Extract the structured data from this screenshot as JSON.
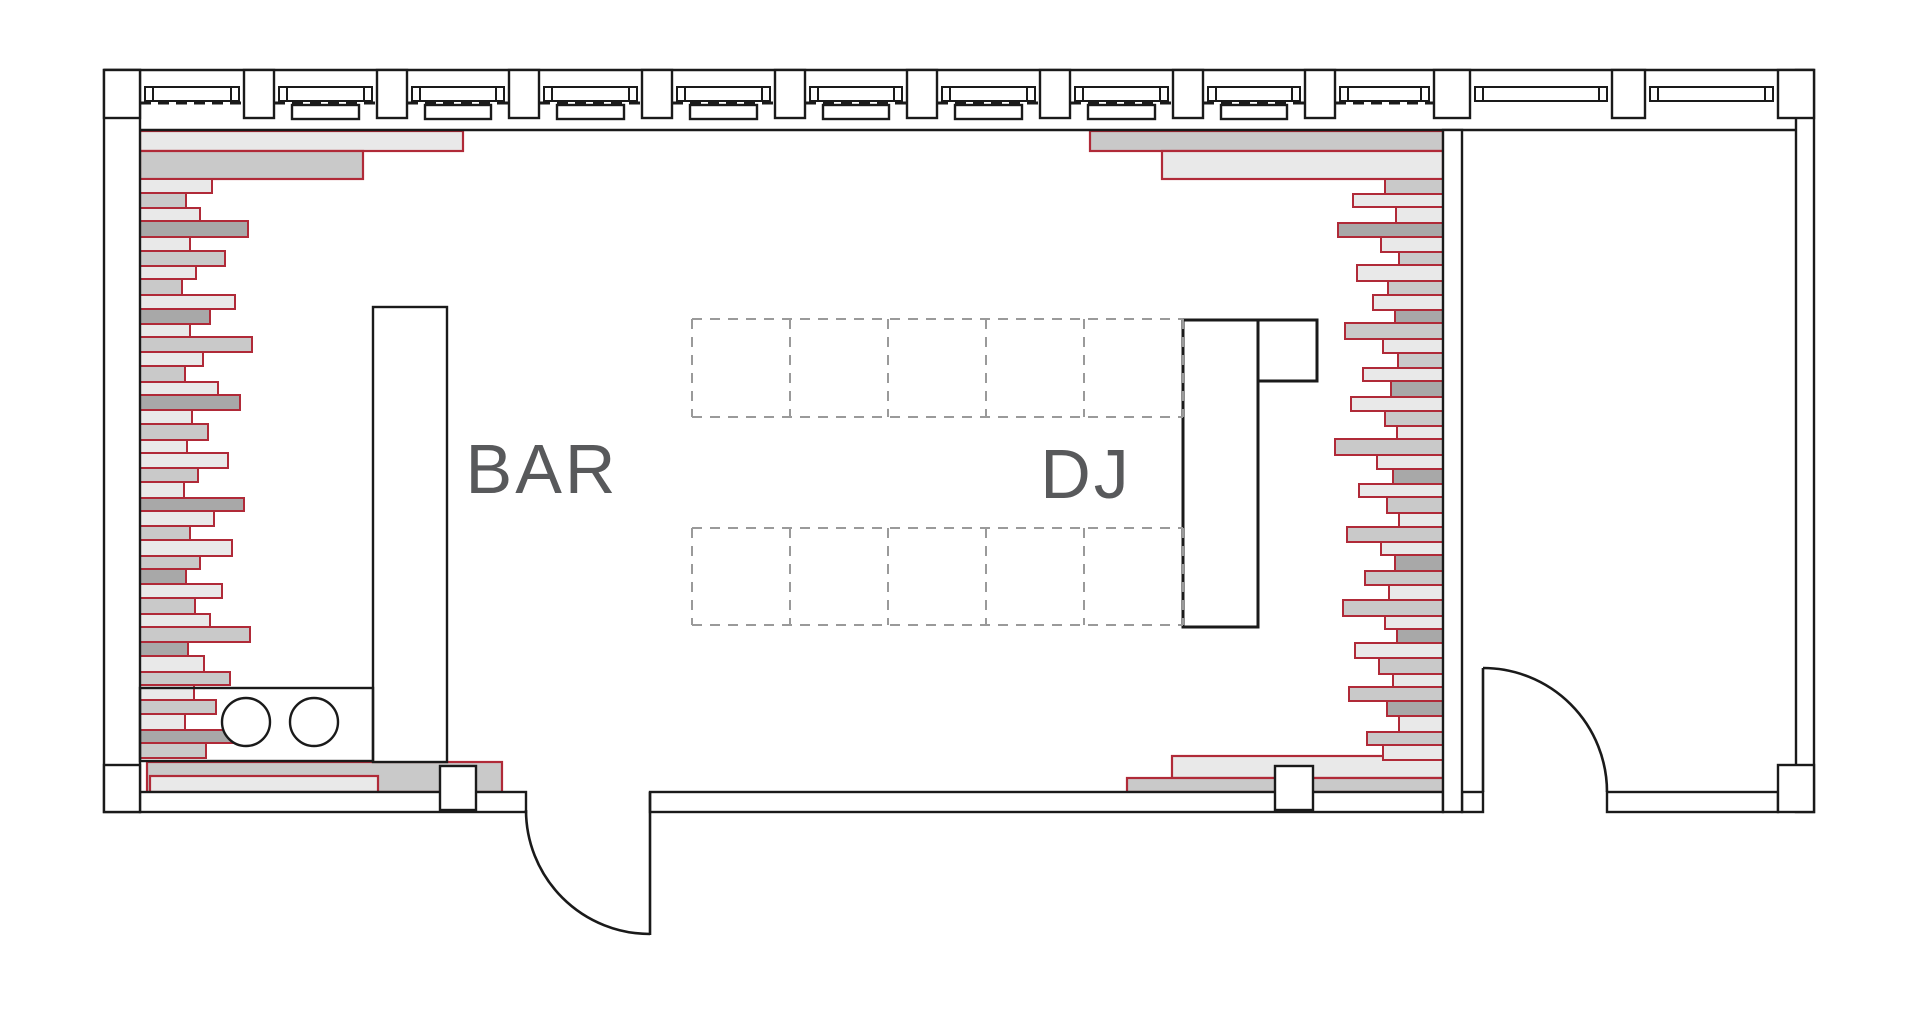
{
  "labels": {
    "bar": "BAR",
    "dj": "DJ"
  },
  "colors": {
    "line": "#1a1a1a",
    "red": "#b02a38",
    "gray_light": "#e9e9e9",
    "gray_mid": "#c9c9c9",
    "gray_dark": "#a8a8a8",
    "label_text": "#58595b",
    "tile_dash": "#9a9a9a",
    "white": "#ffffff"
  },
  "plan": {
    "canvas": {
      "w": 1920,
      "h": 1010
    },
    "outer": {
      "left": 104,
      "right": 1814,
      "top": 70,
      "bottom": 812
    },
    "inner": {
      "left": 140,
      "right": 1796,
      "top_face": 130,
      "bottom_face": 792
    },
    "top_band": {
      "y0": 70,
      "y1": 130,
      "col_y0": 70,
      "col_y1": 118
    },
    "corner_blocks": [
      [
        104,
        70,
        36,
        48
      ],
      [
        1778,
        70,
        36,
        48
      ],
      [
        104,
        765,
        36,
        47
      ],
      [
        1778,
        765,
        36,
        47
      ]
    ],
    "columns_top": [
      [
        244,
        30
      ],
      [
        377,
        30
      ],
      [
        509,
        30
      ],
      [
        642,
        30
      ],
      [
        775,
        30
      ],
      [
        907,
        30
      ],
      [
        1040,
        30
      ],
      [
        1173,
        30
      ],
      [
        1305,
        30
      ],
      [
        1434,
        36
      ],
      [
        1612,
        33
      ]
    ],
    "columns_bottom": [
      [
        440,
        766,
        36,
        44
      ],
      [
        1275,
        766,
        38,
        44
      ]
    ],
    "window_bays": [
      {
        "x0": 140,
        "x1": 244,
        "dash": true,
        "radiator": false
      },
      {
        "x0": 274,
        "x1": 377,
        "dash": true,
        "radiator": true
      },
      {
        "x0": 407,
        "x1": 509,
        "dash": true,
        "radiator": true
      },
      {
        "x0": 539,
        "x1": 642,
        "dash": true,
        "radiator": true
      },
      {
        "x0": 672,
        "x1": 775,
        "dash": true,
        "radiator": true
      },
      {
        "x0": 805,
        "x1": 907,
        "dash": true,
        "radiator": true
      },
      {
        "x0": 937,
        "x1": 1040,
        "dash": true,
        "radiator": true
      },
      {
        "x0": 1070,
        "x1": 1173,
        "dash": true,
        "radiator": true
      },
      {
        "x0": 1203,
        "x1": 1305,
        "dash": true,
        "radiator": true
      },
      {
        "x0": 1335,
        "x1": 1434,
        "dash": true,
        "radiator": false
      },
      {
        "x0": 1470,
        "x1": 1612,
        "dash": false,
        "radiator": false
      },
      {
        "x0": 1645,
        "x1": 1778,
        "dash": false,
        "radiator": false
      }
    ],
    "window": {
      "frame_y0": 87,
      "frame_y1": 101,
      "dash_y": 103,
      "radiator_y0": 105,
      "radiator_y1": 119
    },
    "walls": {
      "left": [
        104,
        70,
        36,
        742
      ],
      "right": [
        1796,
        70,
        18,
        742
      ],
      "partition": [
        1443,
        130,
        19,
        682
      ],
      "bottom_segments": [
        [
          140,
          526
        ],
        [
          650,
          1443
        ],
        [
          1462,
          1483
        ],
        [
          1607,
          1778
        ]
      ],
      "bottom_y0": 792,
      "bottom_y1": 812
    },
    "doors": [
      {
        "name": "main-entrance-door",
        "leaf": [
          650,
          792,
          650,
          935
        ],
        "arc": "M 526 810 A 124 124 0 0 0 650 934"
      },
      {
        "name": "back-room-door",
        "leaf": [
          1483,
          668,
          1483,
          792
        ],
        "arc": "M 1483 668 A 124 124 0 0 1 1607 792"
      }
    ],
    "dance_floor": {
      "x0": 692,
      "x1": 1183,
      "cols": [
        790,
        888,
        986,
        1084
      ],
      "rows": [
        [
          319,
          417
        ],
        [
          528,
          625
        ]
      ]
    },
    "furniture": {
      "bar_counter": [
        373,
        307,
        74,
        455
      ],
      "sink_counter": [
        140,
        688,
        233,
        73
      ],
      "sinks": [
        {
          "cx": 246,
          "cy": 722,
          "r": 24
        },
        {
          "cx": 314,
          "cy": 722,
          "r": 24
        }
      ],
      "dj_booth_main": [
        1183,
        320,
        75,
        307
      ],
      "dj_booth_ext": [
        1258,
        320,
        59,
        61
      ]
    },
    "slabs": [
      [
        140,
        131,
        323,
        20,
        0
      ],
      [
        140,
        151,
        223,
        28,
        1
      ],
      [
        1090,
        131,
        353,
        20,
        1
      ],
      [
        1162,
        151,
        281,
        28,
        0
      ],
      [
        147,
        762,
        355,
        30,
        1
      ],
      [
        150,
        776,
        228,
        16,
        0
      ],
      [
        1172,
        756,
        271,
        22,
        0
      ],
      [
        1127,
        778,
        316,
        14,
        1
      ]
    ],
    "strips": {
      "left": {
        "x": 140,
        "y0": 179,
        "items": [
          [
            72,
            14,
            0
          ],
          [
            46,
            15,
            1
          ],
          [
            60,
            13,
            0
          ],
          [
            108,
            16,
            2
          ],
          [
            50,
            14,
            0
          ],
          [
            85,
            15,
            1
          ],
          [
            56,
            13,
            0
          ],
          [
            42,
            16,
            1
          ],
          [
            95,
            14,
            0
          ],
          [
            70,
            15,
            2
          ],
          [
            50,
            13,
            0
          ],
          [
            112,
            15,
            1
          ],
          [
            63,
            14,
            0
          ],
          [
            45,
            16,
            1
          ],
          [
            78,
            13,
            0
          ],
          [
            100,
            15,
            2
          ],
          [
            52,
            14,
            0
          ],
          [
            68,
            16,
            1
          ],
          [
            47,
            13,
            0
          ],
          [
            88,
            15,
            0
          ],
          [
            58,
            14,
            1
          ],
          [
            44,
            16,
            0
          ],
          [
            104,
            13,
            2
          ],
          [
            74,
            15,
            0
          ],
          [
            50,
            14,
            1
          ],
          [
            92,
            16,
            0
          ],
          [
            60,
            13,
            1
          ],
          [
            46,
            15,
            2
          ],
          [
            82,
            14,
            0
          ],
          [
            55,
            16,
            1
          ],
          [
            70,
            13,
            0
          ],
          [
            110,
            15,
            1
          ],
          [
            48,
            14,
            2
          ],
          [
            64,
            16,
            0
          ],
          [
            90,
            13,
            1
          ],
          [
            54,
            15,
            0
          ],
          [
            76,
            14,
            1
          ],
          [
            45,
            16,
            0
          ],
          [
            96,
            13,
            2
          ],
          [
            66,
            15,
            1
          ]
        ]
      },
      "right": {
        "x_anchor": 1443,
        "y0": 179,
        "items": [
          [
            58,
            15,
            1
          ],
          [
            90,
            13,
            0
          ],
          [
            47,
            16,
            0
          ],
          [
            105,
            14,
            2
          ],
          [
            62,
            15,
            0
          ],
          [
            44,
            13,
            1
          ],
          [
            86,
            16,
            0
          ],
          [
            55,
            14,
            1
          ],
          [
            70,
            15,
            0
          ],
          [
            48,
            13,
            2
          ],
          [
            98,
            16,
            1
          ],
          [
            60,
            14,
            0
          ],
          [
            45,
            15,
            1
          ],
          [
            80,
            13,
            0
          ],
          [
            52,
            16,
            2
          ],
          [
            92,
            14,
            0
          ],
          [
            58,
            15,
            1
          ],
          [
            46,
            13,
            0
          ],
          [
            108,
            16,
            1
          ],
          [
            66,
            14,
            0
          ],
          [
            50,
            15,
            2
          ],
          [
            84,
            13,
            0
          ],
          [
            56,
            16,
            1
          ],
          [
            44,
            14,
            0
          ],
          [
            96,
            15,
            1
          ],
          [
            62,
            13,
            0
          ],
          [
            48,
            16,
            2
          ],
          [
            78,
            14,
            1
          ],
          [
            54,
            15,
            0
          ],
          [
            100,
            16,
            1
          ],
          [
            58,
            13,
            0
          ],
          [
            46,
            14,
            2
          ],
          [
            88,
            15,
            0
          ],
          [
            64,
            16,
            1
          ],
          [
            50,
            13,
            0
          ],
          [
            94,
            14,
            1
          ],
          [
            56,
            15,
            2
          ],
          [
            44,
            16,
            0
          ],
          [
            76,
            13,
            1
          ],
          [
            60,
            15,
            0
          ]
        ]
      }
    },
    "label_pos": {
      "bar": {
        "x": 542,
        "y": 493,
        "size": 70
      },
      "dj": {
        "x": 1086,
        "y": 498,
        "size": 70
      }
    }
  }
}
